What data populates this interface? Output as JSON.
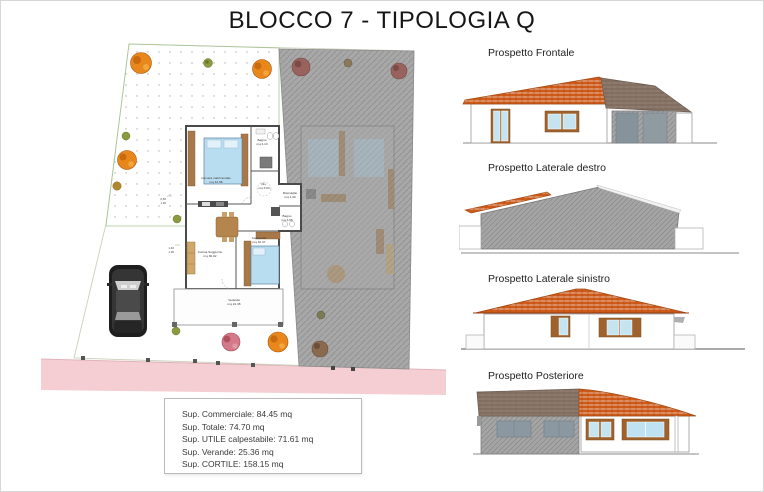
{
  "title": "BLOCCO 7 - TIPOLOGIA Q",
  "elevations": [
    {
      "label": "Prospetto Frontale"
    },
    {
      "label": "Prospetto Laterale destro"
    },
    {
      "label": "Prospetto Laterale sinistro"
    },
    {
      "label": "Prospetto Posteriore"
    }
  ],
  "summary": {
    "lines": [
      "Sup. Commerciale: 84.45 mq",
      "Sup. Totale: 74.70 mq",
      "Sup. UTILE calpestabile: 71.61 mq",
      "Sup. Verande: 25.36 mq",
      "Sup. CORTILE: 158.15 mq"
    ]
  },
  "floor_plan": {
    "rooms": [
      {
        "name": "Camera matrimoniale",
        "area": "mq 12.98"
      },
      {
        "name": "Bagno",
        "area": "mq 4.13"
      },
      {
        "name": "Dis.",
        "area": "mq 3.04"
      },
      {
        "name": "Ripostiglio",
        "area": "mq 1.30"
      },
      {
        "name": "Bagno",
        "area": "mq 3.96"
      },
      {
        "name": "Cameretta",
        "area": "mq 10.37"
      },
      {
        "name": "Cucina Soggiorno",
        "area": "mq 30.02"
      },
      {
        "name": "Veranda",
        "area": "mq 21.38"
      }
    ],
    "dimensions": [
      [
        "0.60",
        "1.30"
      ],
      [
        "1.40",
        "1.30"
      ]
    ]
  },
  "colors": {
    "roof_tile_orange": "#cf5a1a",
    "neighbor_gray": "#a5a5a5",
    "road_pink": "#f4ced2",
    "glass_blue": "#c6e4f0",
    "shutter_brown": "#a0622d"
  }
}
